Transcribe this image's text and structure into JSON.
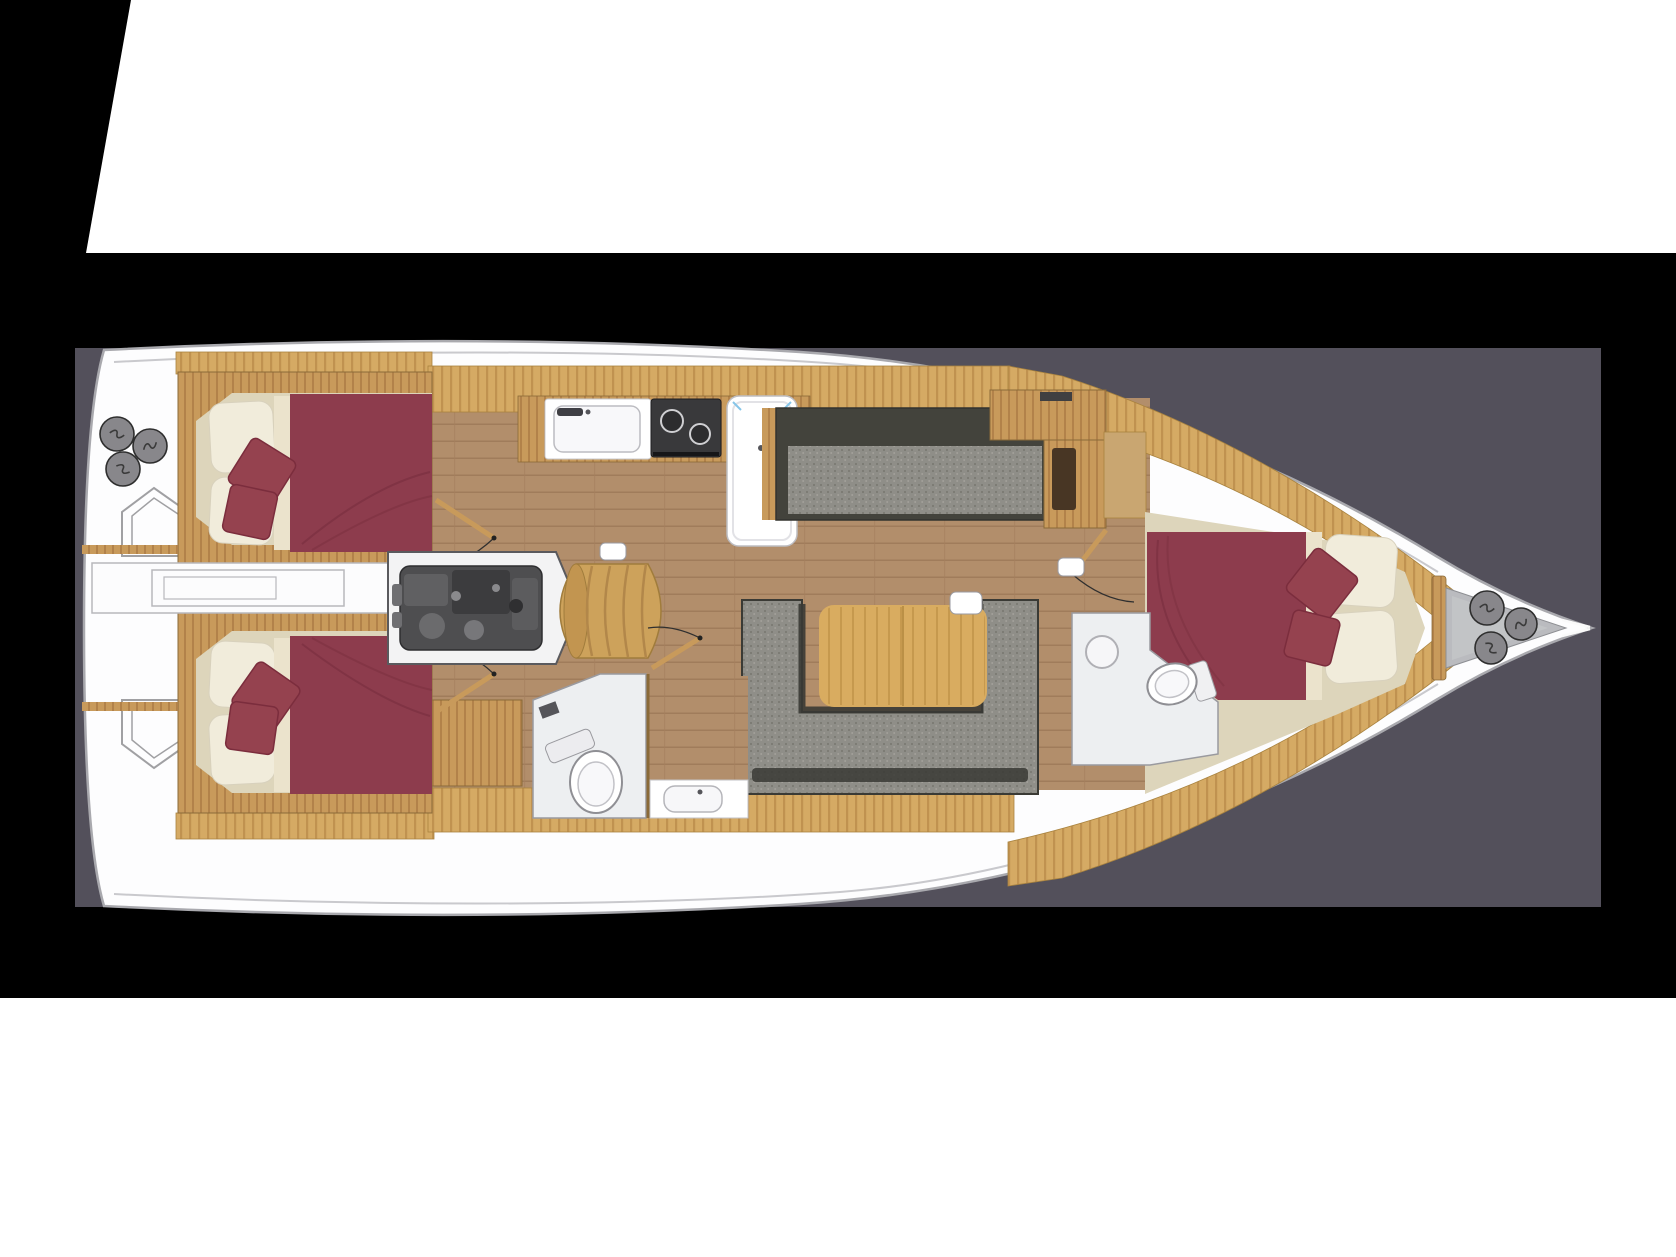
{
  "scene": {
    "type": "sailing-yacht-interior-floor-plan",
    "orientation": "bow-to-the-right",
    "visible_text": ""
  },
  "palette": {
    "page_white": "#ffffff",
    "outer_black": "#000000",
    "panel_gray": "#53505b",
    "hull_white": "#fdfdfe",
    "hull_outline": "#a9a9ae",
    "deck_teak": "#d5aa64",
    "wood_trim": "#c89a5b",
    "floor_wood": "#b28e6b",
    "cabin_beige": "#ddd5bb",
    "bed_burgundy": "#8d3c4d",
    "pillow_cream": "#f1ecdb",
    "sofa_gray": "#8f8e88",
    "sofa_dark": "#43433c",
    "table_wood": "#d9ac60",
    "engine_gray": "#4e4e50",
    "deck_fitting_gray": "#88878b",
    "head_floor": "#edeff1",
    "fixture_white": "#ffffff",
    "bow_locker_gray": "#babbbf"
  },
  "boat": {
    "rooms": [
      {
        "id": "aft-cabin-port",
        "label": "Aft double cabin (port)",
        "bed": "double",
        "pillows": 2,
        "throw_pillows": 2
      },
      {
        "id": "aft-cabin-starboard",
        "label": "Aft double cabin (starboard)",
        "bed": "double",
        "pillows": 2,
        "throw_pillows": 2
      },
      {
        "id": "engine-compartment",
        "label": "Engine compartment"
      },
      {
        "id": "companionway",
        "label": "Companionway steps"
      },
      {
        "id": "galley",
        "label": "Galley",
        "equipment": [
          "sink",
          "two-burner-stove",
          "fridge"
        ]
      },
      {
        "id": "salon",
        "label": "Salon",
        "equipment": [
          "settee",
          "dining-table",
          "u-shaped-sofa"
        ]
      },
      {
        "id": "aft-head",
        "label": "Aft head",
        "equipment": [
          "toilet",
          "washbasin"
        ]
      },
      {
        "id": "fwd-head",
        "label": "Forward head",
        "equipment": [
          "toilet",
          "washbasin"
        ]
      },
      {
        "id": "fwd-cabin",
        "label": "Forward V-berth cabin",
        "bed": "double",
        "pillows": 2,
        "throw_pillows": 2
      },
      {
        "id": "bow-locker",
        "label": "Bow anchor locker"
      },
      {
        "id": "stern-deck",
        "label": "Stern swim platform"
      }
    ],
    "deck_fittings": {
      "stern_circle_count": 3,
      "bow_circle_count": 3
    },
    "beds": {
      "double_berths": 3,
      "pillows_per_berth": 2,
      "throw_pillows_per_berth": 2
    }
  }
}
